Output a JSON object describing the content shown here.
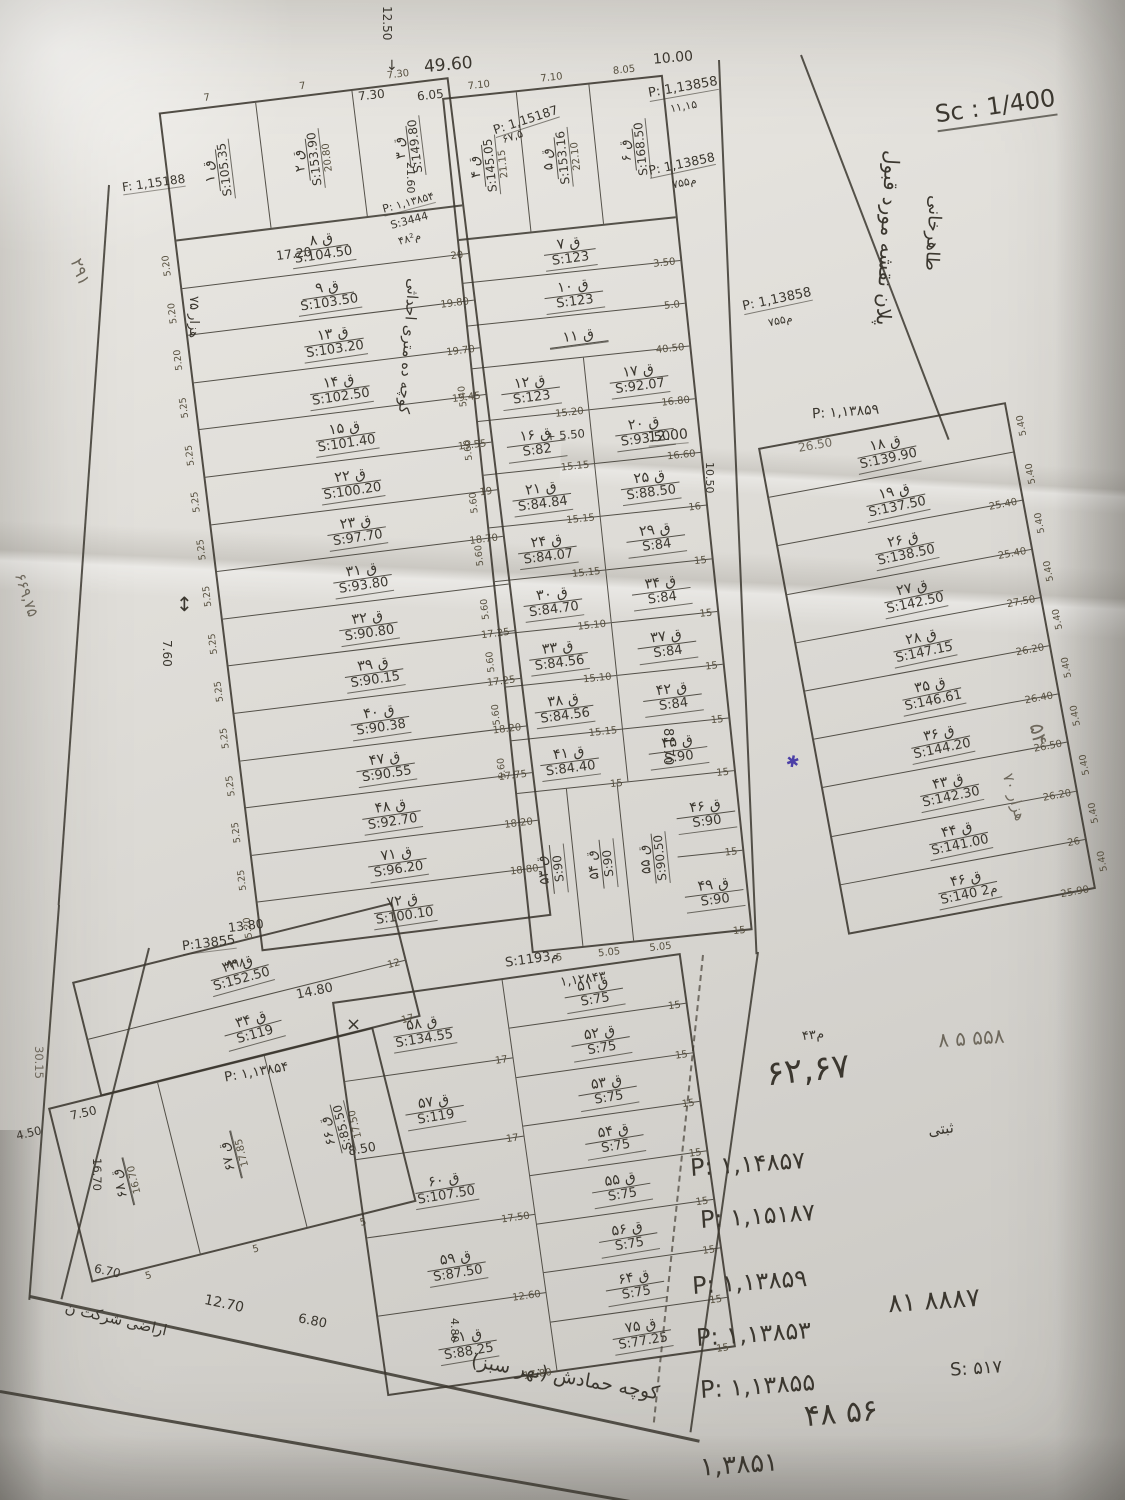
{
  "notes": {
    "sc_note": "Sc : 1/400",
    "plan_line1": "پلان نقشه مورد قبول",
    "plan_line2": "طاهرخانی",
    "d4960": "49.60",
    "d1250": "12.50",
    "d730": "7.30",
    "d605": "6.05",
    "d1000": "10.00",
    "arrow_down": "↓",
    "arrow_updown": "↕",
    "xmark": "×",
    "star": "✱",
    "p15187_top": "P: 1,15187",
    "p15187_sub": "۶۷,۵",
    "p13858_t1": "P: 1,13858",
    "p13858_t1_sub": "۱۱,۱۵",
    "p13858_t2": "P: 1,13858",
    "p13858_t2_sub": "۷۵۵م",
    "p13858_t3": "P: 1,13858",
    "p13858_t3_sub": "۷۵۵م",
    "p13859_r": "P: ۱,۱۳۸۵۹",
    "d1200": "12.00",
    "d1050": "10.50",
    "d550": "+ 5.50",
    "d2160": "21.60",
    "d1720": "17.20",
    "n291": "۲۹۱",
    "f15188": "F: 1,15188",
    "n75h": "۷۵ هزار",
    "n66975": "۶۶۹,۷۵",
    "d760": "7.60",
    "n54": "۵۴",
    "n70h": "۷۰ هزار",
    "d8170": "81.70",
    "d2650": "26.50",
    "s1193": "S:1193م",
    "p12843": "۱,۱۲۸۴۳",
    "d1380": "13.80",
    "p13855": "P:13855",
    "p13855_sub": "۸۹۸",
    "d1480": "14.80",
    "p13854b": "P: ۱,۱۳۸۵۴",
    "d750t": "7.50",
    "d450t": "4.50",
    "d3015": "30.15",
    "d1670": "16.70",
    "d670": "6.70",
    "d850m": "8.50",
    "d480": "4.80",
    "d1270": "12.70",
    "d680": "6.80",
    "araz": "اراضی شرکت ن",
    "street_bottom": "کوچه حمادش (نهر سبز)",
    "street_left_label": "کوچه ده متری احداثی",
    "street_left_p": "P: ۱,۱۳۸۵۴",
    "street_left_s": "S:3444",
    "street_left_m": "۴۸م²",
    "n558": "۸ ۵ ۵۵۸",
    "big_6267": "۶۲,۶۷",
    "big_6267_sub": "۴۳م",
    "p14857": "P: ۱,۱۴۸۵۷",
    "p15187b": "P: ۱,۱۵۱۸۷",
    "p13859b": "P: ۱,۱۳۸۵۹",
    "n8887": "۸۱ ۸۸۸۷",
    "p13853": "P: ۱,۱۳۸۵۳",
    "p13855b": "P: ۱,۱۳۸۵۵",
    "s517": "S: ۵۱۷",
    "big4856": "۴۸ ۵۶",
    "n13851": "۱,۳۸۵۱",
    "note_sabti": "ثبتی"
  },
  "left_block": {
    "top_plots": [
      {
        "num": "ق ۱",
        "area": "S:105.35",
        "w": "7",
        "dim": ""
      },
      {
        "num": "ق ۲",
        "area": "S:153.90",
        "w": "7",
        "dim": "20.80"
      },
      {
        "num": "ق ۳",
        "area": "S:149.80",
        "w": "7.30",
        "dim": ""
      }
    ],
    "rows": [
      {
        "num": "ق ۸",
        "area": "S:104.50",
        "dim": "20",
        "w": "5.20"
      },
      {
        "num": "ق ۹",
        "area": "S:103.50",
        "dim": "19.80",
        "w": "5.20"
      },
      {
        "num": "ق ۱۳",
        "area": "S:103.20",
        "dim": "19.70",
        "w": "5.20"
      },
      {
        "num": "ق ۱۴",
        "area": "S:102.50",
        "dim": "19.45",
        "w": "5.25"
      },
      {
        "num": "ق ۱۵",
        "area": "S:101.40",
        "dim": "19.55",
        "w": "5.25"
      },
      {
        "num": "ق ۲۲",
        "area": "S:100.20",
        "dim": "19",
        "w": "5.25"
      },
      {
        "num": "ق ۲۳",
        "area": "S:97.70",
        "dim": "18.70",
        "w": "5.25"
      },
      {
        "num": "ق ۳۱",
        "area": "S:93.80",
        "dim": "",
        "w": "5.25"
      },
      {
        "num": "ق ۳۲",
        "area": "S:90.80",
        "dim": "17.25",
        "w": "5.25"
      },
      {
        "num": "ق ۳۹",
        "area": "S:90.15",
        "dim": "17.25",
        "w": "5.25"
      },
      {
        "num": "ق ۴۰",
        "area": "S:90.38",
        "dim": "18.20",
        "w": "5.25"
      },
      {
        "num": "ق ۴۷",
        "area": "S:90.55",
        "dim": "17.75",
        "w": "5.25"
      },
      {
        "num": "ق ۴۸",
        "area": "S:92.70",
        "dim": "18.20",
        "w": "5.25"
      },
      {
        "num": "ق ۷۱",
        "area": "S:96.20",
        "dim": "18.80",
        "w": "5.25"
      },
      {
        "num": "ق ۷۲",
        "area": "S:100.10",
        "dim": "",
        "w": "5.20"
      }
    ]
  },
  "middle_block": {
    "top_plots": [
      {
        "num": "ق ۴",
        "area": "S:145.05",
        "w": "7.10",
        "dim": "21.15"
      },
      {
        "num": "ق ۵",
        "area": "S:153.16",
        "w": "7.10",
        "dim": "22.10"
      },
      {
        "num": "ق ۶",
        "area": "S:168.50",
        "w": "8.05",
        "dim": ""
      }
    ],
    "full_rows": [
      {
        "num": "ق ۷",
        "area": "S:123",
        "dim": "3.50"
      },
      {
        "num": "ق ۱۰",
        "area": "S:123",
        "dim": "5.0"
      },
      {
        "num": "ق ۱۱",
        "area": "",
        "dim": "40.50"
      }
    ],
    "left_rows": [
      {
        "num": "ق ۱۲",
        "area": "S:123",
        "dim": "15.20",
        "w": "5.40"
      },
      {
        "num": "ق ۱۶",
        "area": "S:82",
        "dim": "15.15",
        "w": "5.60"
      },
      {
        "num": "ق ۲۱",
        "area": "S:84.84",
        "dim": "15.15",
        "w": "5.60"
      },
      {
        "num": "ق ۲۴",
        "area": "S:84.07",
        "dim": "15.15",
        "w": "5.60"
      },
      {
        "num": "ق ۳۰",
        "area": "S:84.70",
        "dim": "15.10",
        "w": "5.60"
      },
      {
        "num": "ق ۳۳",
        "area": "S:84.56",
        "dim": "15.10",
        "w": "5.60"
      },
      {
        "num": "ق ۳۸",
        "area": "S:84.56",
        "dim": "15.15",
        "w": "5.60"
      },
      {
        "num": "ق ۴۱",
        "area": "S:84.40",
        "dim": "15",
        "w": "5.60"
      }
    ],
    "right_rows": [
      {
        "num": "ق ۱۷",
        "area": "S:92.07",
        "dim": "16.80"
      },
      {
        "num": "ق ۲۰",
        "area": "S:93.50",
        "dim": "16.60"
      },
      {
        "num": "ق ۲۵",
        "area": "S:88.50",
        "dim": "16"
      },
      {
        "num": "ق ۲۹",
        "area": "S:84",
        "dim": "15"
      },
      {
        "num": "ق ۳۴",
        "area": "S:84",
        "dim": "15"
      },
      {
        "num": "ق ۳۷",
        "area": "S:84",
        "dim": "15"
      },
      {
        "num": "ق ۴۲",
        "area": "S:84",
        "dim": "15"
      },
      {
        "num": "ق ۴۵",
        "area": "S:90",
        "dim": "15"
      }
    ],
    "bottom_trio": [
      {
        "num": "ق ۵۳",
        "area": "S:90",
        "w": "5"
      },
      {
        "num": "ق ۵۴",
        "area": "S:90",
        "w": "5.05"
      },
      {
        "num": "ق ۵۵",
        "area": "S:90.50",
        "w": "5.05"
      }
    ],
    "bottom_right_rows": [
      {
        "num": "ق ۴۶",
        "area": "S:90",
        "dim": "15"
      },
      {
        "num": "ق ۴۹",
        "area": "S:90",
        "dim": "15"
      }
    ]
  },
  "right_block": {
    "rows": [
      {
        "num": "ق ۱۸",
        "area": "S:139.90",
        "dim": "",
        "w": "5.40"
      },
      {
        "num": "ق ۱۹",
        "area": "S:137.50",
        "dim": "25.40",
        "w": "5.40"
      },
      {
        "num": "ق ۲۶",
        "area": "S:138.50",
        "dim": "25.40",
        "w": "5.40"
      },
      {
        "num": "ق ۲۷",
        "area": "S:142.50",
        "dim": "27.50",
        "w": "5.40"
      },
      {
        "num": "ق ۲۸",
        "area": "S:147.15",
        "dim": "26.20",
        "w": "5.40"
      },
      {
        "num": "ق ۳۵",
        "area": "S:146.61",
        "dim": "26.40",
        "w": "5.40"
      },
      {
        "num": "ق ۳۶",
        "area": "S:144.20",
        "dim": "26.50",
        "w": "5.40"
      },
      {
        "num": "ق ۴۳",
        "area": "S:142.30",
        "dim": "26.20",
        "w": "5.40"
      },
      {
        "num": "ق ۴۴",
        "area": "S:141.00",
        "dim": "26",
        "w": "5.40"
      },
      {
        "num": "ق ۴۶",
        "area": "S:140 م2",
        "dim": "25.90",
        "w": "5.40"
      }
    ]
  },
  "bottom_left_block": {
    "upper_rows": [
      {
        "num": "ق ۳۳",
        "area": "S:152.50",
        "dim": "12"
      },
      {
        "num": "ق ۳۴",
        "area": "S:119",
        "dim": "17"
      }
    ],
    "lower_plots": [
      {
        "num": "ق ۶۸",
        "area": "",
        "dim": "16.70",
        "w": "5"
      },
      {
        "num": "ق ۶۷",
        "area": "",
        "dim": "17.85",
        "w": "5"
      },
      {
        "num": "ق ۶۶",
        "area": "S:85.50",
        "dim": "17.50",
        "w": "5"
      }
    ]
  },
  "bottom_mid_block": {
    "left_rows": [
      {
        "num": "ق ۵۸",
        "area": "S:134.55",
        "dim": "17"
      },
      {
        "num": "ق ۵۷",
        "area": "S:119",
        "dim": "17"
      },
      {
        "num": "ق ۶۰",
        "area": "S:107.50",
        "dim": "17.50"
      },
      {
        "num": "ق ۵۹",
        "area": "S:87.50",
        "dim": "12.60"
      },
      {
        "num": "ق ۶۱",
        "area": "S:88.25",
        "dim": "17.80"
      }
    ],
    "right_rows": [
      {
        "num": "ق ۵۱",
        "area": "S:75",
        "dim": "15"
      },
      {
        "num": "ق ۵۲",
        "area": "S:75",
        "dim": "15"
      },
      {
        "num": "ق ۵۳",
        "area": "S:75",
        "dim": "15"
      },
      {
        "num": "ق ۵۴",
        "area": "S:75",
        "dim": "15"
      },
      {
        "num": "ق ۵۵",
        "area": "S:75",
        "dim": "15"
      },
      {
        "num": "ق ۵۶",
        "area": "S:75",
        "dim": "15"
      },
      {
        "num": "ق ۶۴",
        "area": "S:75",
        "dim": "15"
      },
      {
        "num": "ق ۷۵",
        "area": "S:77.25",
        "dim": "15"
      }
    ]
  }
}
